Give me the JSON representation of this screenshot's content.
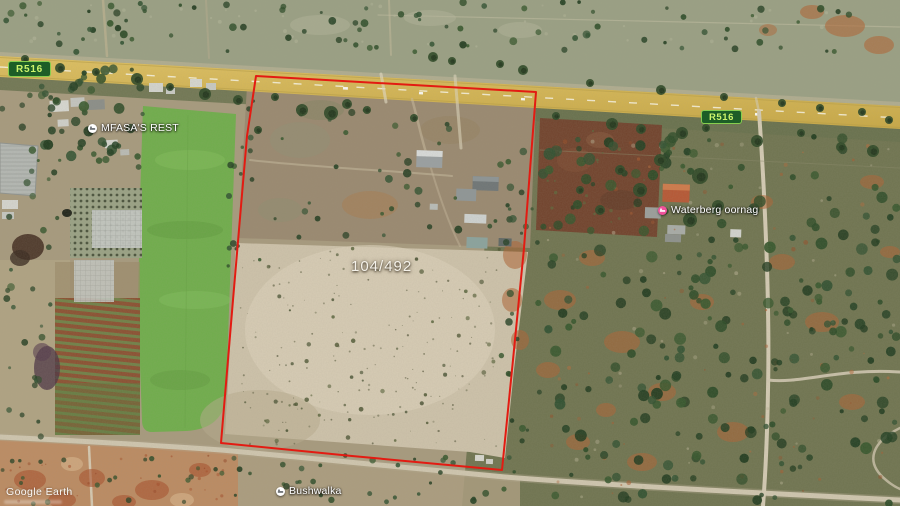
{
  "app": {
    "watermark": "Google Earth"
  },
  "map": {
    "parcel": {
      "label": "104/492"
    },
    "road_shields": [
      {
        "label": "R516"
      },
      {
        "label": "R516"
      }
    ],
    "places": [
      {
        "name": "MFASA'S REST",
        "category": "lodging",
        "pin_color": "#ffffff",
        "glyph_color": "#5f6368"
      },
      {
        "name": "Waterberg oornag",
        "category": "lodging",
        "pin_color": "#f0519b",
        "glyph_color": "#ffffff"
      },
      {
        "name": "Bushwalka",
        "category": "lodging",
        "pin_color": "#ffffff",
        "glyph_color": "#5f6368"
      }
    ],
    "colors": {
      "boundary": "#e31b12",
      "shield_bg": "#1d5e27",
      "shield_border": "#86ce4e",
      "shield_text": "#cdf46c",
      "road": "#d7b751"
    }
  }
}
